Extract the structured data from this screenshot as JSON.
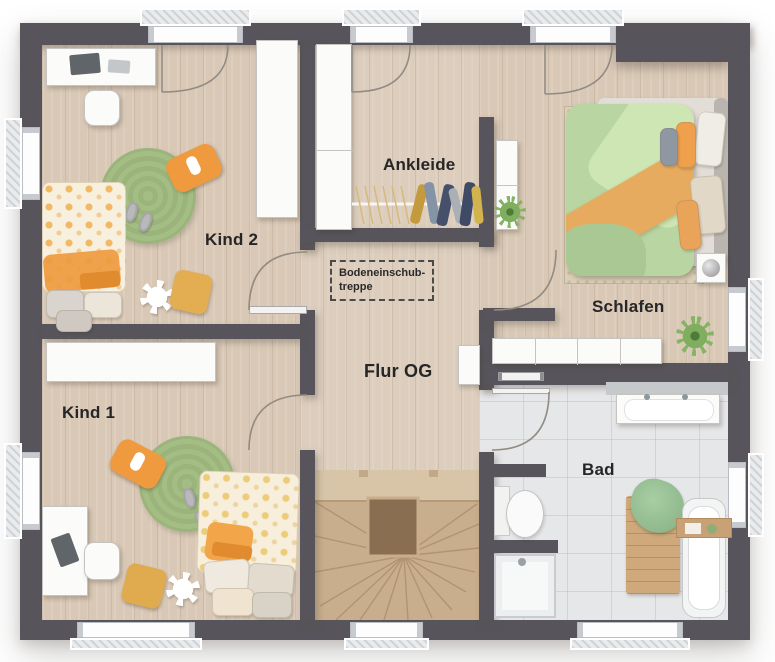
{
  "plan": {
    "title": "upper-floor-plan",
    "rooms": [
      {
        "id": "kind2",
        "label": "Kind 2"
      },
      {
        "id": "kind1",
        "label": "Kind 1"
      },
      {
        "id": "ankleide",
        "label": "Ankleide"
      },
      {
        "id": "schlafen",
        "label": "Schlafen"
      },
      {
        "id": "bad",
        "label": "Bad"
      },
      {
        "id": "flur",
        "label": "Flur OG"
      }
    ],
    "attic_hatch": {
      "line1": "Bodeneinschub-",
      "line2": "treppe"
    },
    "colors": {
      "wall": "#57555b",
      "wood": "#d9c8b6",
      "tile": "#e6e7e9",
      "rug": "#a4bd85",
      "orange": "#ef9a3e",
      "stairwood": "#c9ae8d",
      "duvetgreen": "#b9d6a2",
      "blanketorange": "#e7ab60",
      "label": "#262626"
    }
  }
}
